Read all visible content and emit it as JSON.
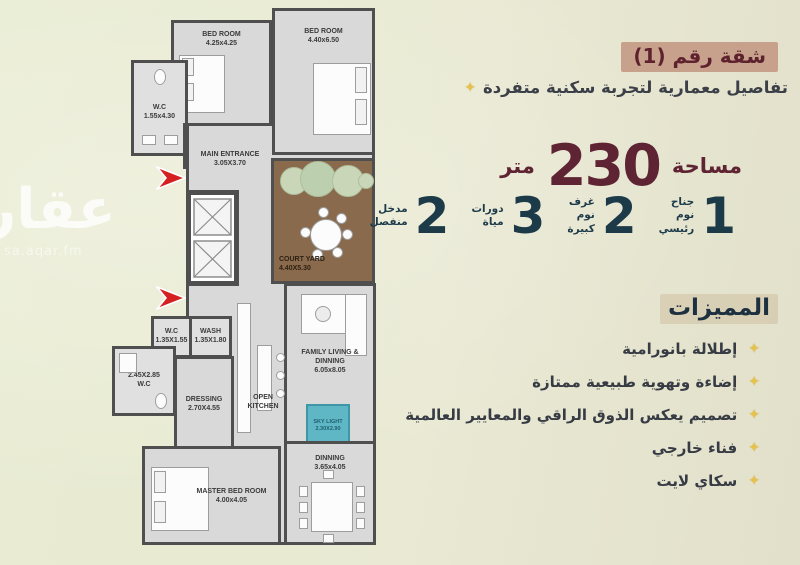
{
  "watermark": {
    "logo": "عقار",
    "site": "sa.aqar.fm"
  },
  "panel": {
    "badge": "شقة رقم (1)",
    "subtitle": "تفاصيل معمارية لتجربة سكنية متفردة",
    "sparkle_icon": "✦",
    "area": {
      "label": "مساحة",
      "value": "230",
      "unit": "متر"
    },
    "stats": [
      {
        "value": "1",
        "label": "جناح\nنوم\nرئيسي"
      },
      {
        "value": "2",
        "label": "غرف\nنوم\nكبيرة"
      },
      {
        "value": "3",
        "label": "دورات\nمياة"
      },
      {
        "value": "2",
        "label": "مدخل\nمنفصل"
      }
    ],
    "features_title": "المميزات",
    "features": [
      "إطلالة بانورامية",
      "إضاءة وتهوية طبيعية ممتازة",
      "تصميم يعكس الذوق الراقي والمعايير العالمية",
      "فناء خارجي",
      "سكاي لايت"
    ]
  },
  "floorplan": {
    "rooms": {
      "bedroom_tl": {
        "name": "BED ROOM",
        "dims": "4.25x4.25"
      },
      "bedroom_tr": {
        "name": "BED ROOM",
        "dims": "4.40x6.50"
      },
      "wc_top": {
        "name": "W.C",
        "dims": "1.55x4.30"
      },
      "main_entrance": {
        "name": "MAIN ENTRANCE",
        "dims": "3.05X3.70"
      },
      "court_yard": {
        "name": "COURT YARD",
        "dims": "4.40X5.30"
      },
      "wc_mid": {
        "name": "W.C",
        "dims": "1.35X1.55"
      },
      "wash": {
        "name": "WASH",
        "dims": "1.35X1.80"
      },
      "wc_left": {
        "name": "W.C",
        "dims": "2.45X2.85"
      },
      "dressing": {
        "name": "DRESSING",
        "dims": "2.70X4.55"
      },
      "open_kitchen": {
        "name": "OPEN KITCHEN",
        "dims": ""
      },
      "family_living": {
        "name": "FAMILY LIVING & DINNING",
        "dims": "6.05x8.05"
      },
      "sky_light": {
        "name": "SKY LIGHT",
        "dims": "2.30X2.90"
      },
      "master_bed": {
        "name": "MASTER BED ROOM",
        "dims": "4.00x4.05"
      },
      "dinning": {
        "name": "DINNING",
        "dims": "3.65x4.05"
      }
    }
  },
  "colors": {
    "maroon": "#5e2433",
    "navy": "#1d3a49",
    "badge_bg": "#c8a18d",
    "gold": "#e6c14b",
    "wall": "#4f4f4f",
    "floor": "#d9d9d9",
    "wood": "#8a6a4d",
    "skylight": "#5fb7c6",
    "arrow_red": "#d42020"
  }
}
